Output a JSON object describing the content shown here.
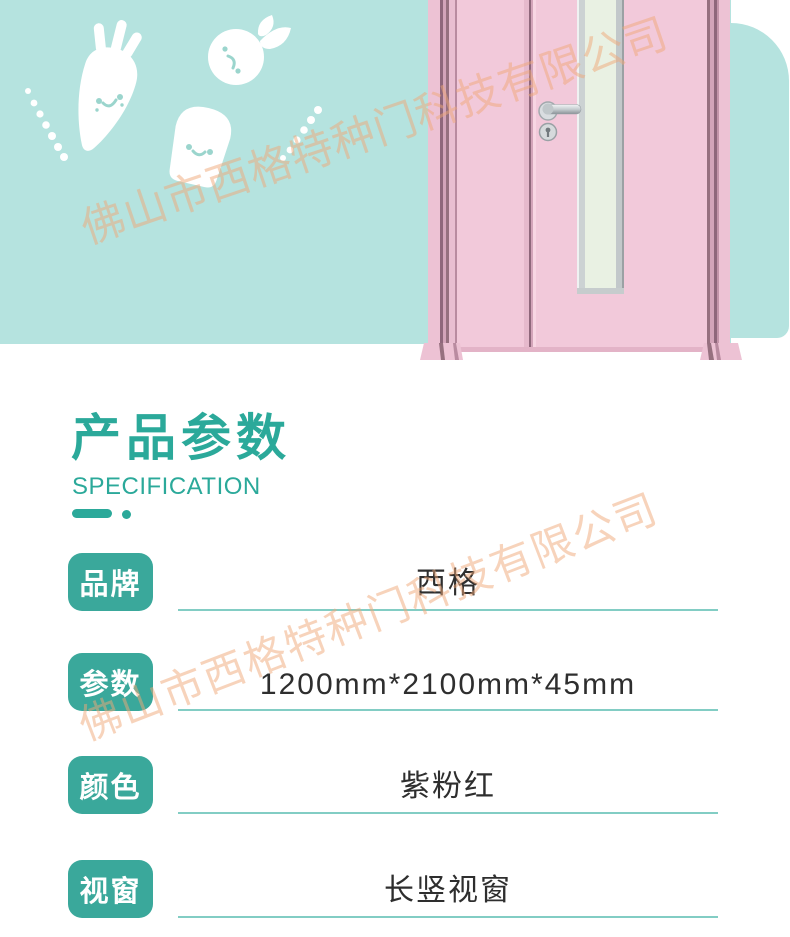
{
  "page": {
    "width": 790,
    "height": 937,
    "background": "#ffffff"
  },
  "watermark": {
    "text": "佛山市西格特种门科技有限公司",
    "color": "#f0a878"
  },
  "hero": {
    "background_color": "#b5e3df",
    "decorations": [
      {
        "icon": "carrot-icon"
      },
      {
        "icon": "apple-icon"
      },
      {
        "icon": "toast-bread-icon"
      },
      {
        "icon": "dotted-line-left-icon"
      },
      {
        "icon": "dotted-line-right-icon"
      }
    ],
    "product_image": {
      "icon": "pink-double-door-image",
      "door_color": "#f2c9da",
      "glass_color": "#e9f1e3",
      "frame_shadow_color": "#8f677b",
      "hardware_chrome_color": "#c6cdd0"
    }
  },
  "section": {
    "title": "产品参数",
    "subtitle": "SPECIFICATION",
    "accent_color": "#2ba99a",
    "underline_color": "#82cdc4"
  },
  "spec": {
    "label_badge_color": "#3aa89b",
    "value_text_color": "#2e2e2e",
    "rows": [
      {
        "label": "品牌",
        "value": "西格"
      },
      {
        "label": "参数",
        "value": "1200mm*2100mm*45mm"
      },
      {
        "label": "颜色",
        "value": "紫粉红"
      },
      {
        "label": "视窗",
        "value": "长竖视窗"
      }
    ]
  }
}
